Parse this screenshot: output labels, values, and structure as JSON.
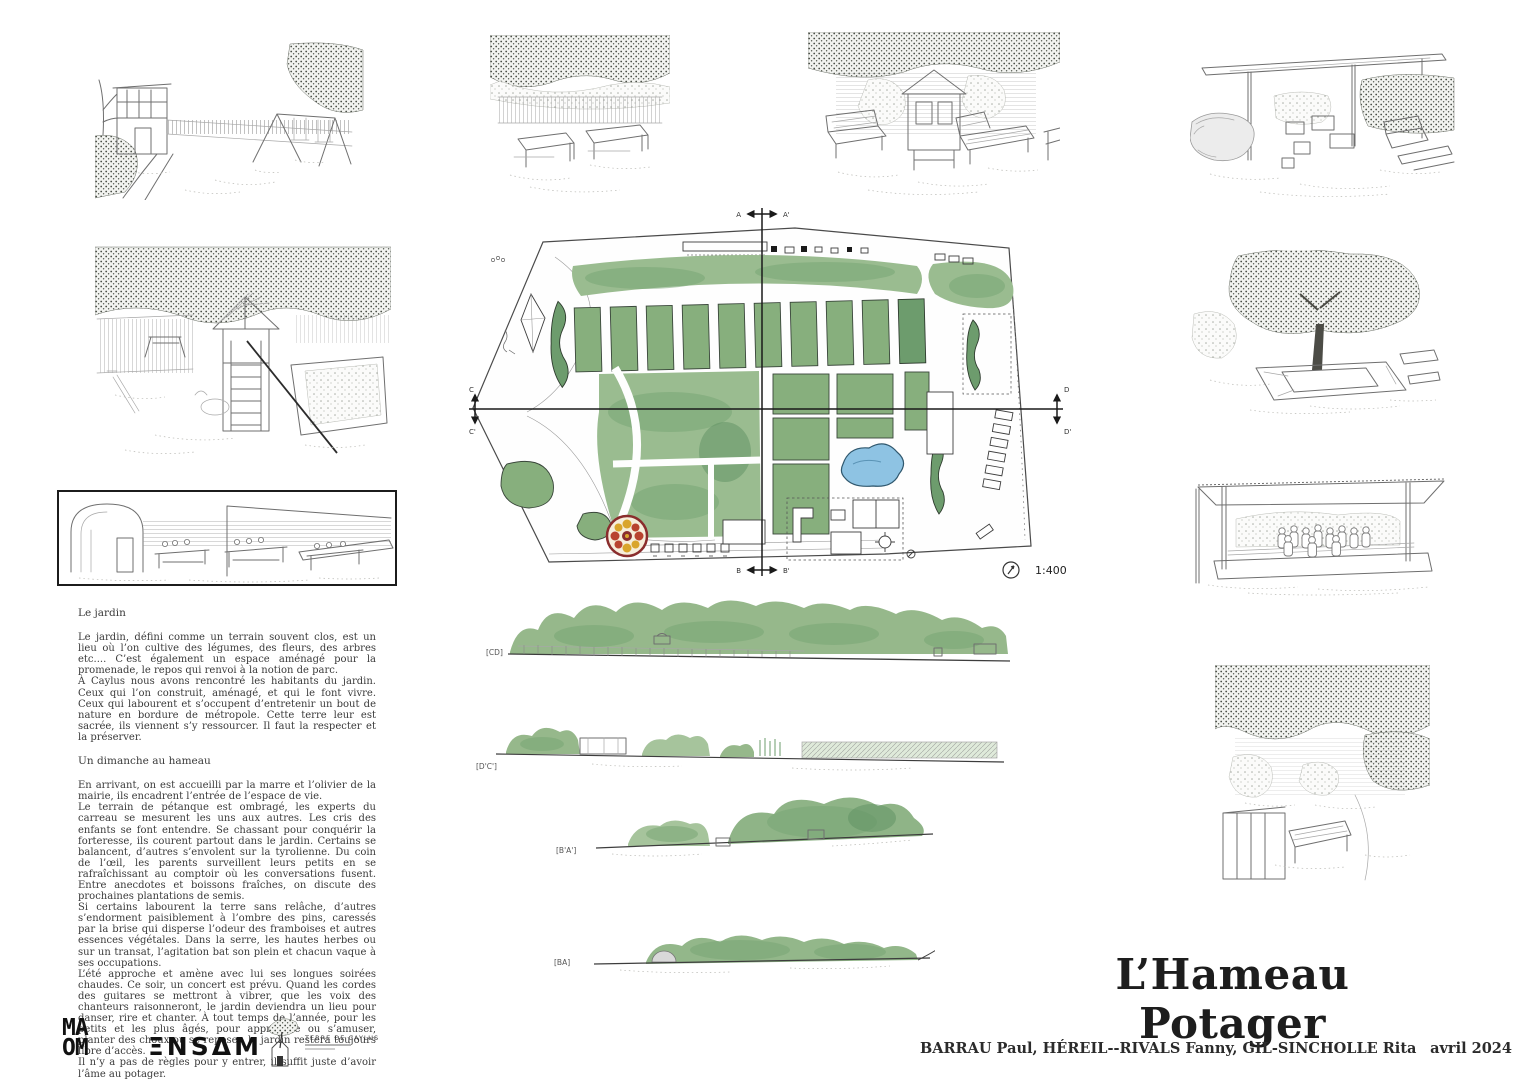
{
  "board": {
    "title": "L’Hameau Potager",
    "credits": "BARRAU Paul, HÉREIL--RIVALS Fanny, GIL-SINCHOLLE Rita",
    "date": "avril 2024"
  },
  "text_panel": {
    "heading_jardin": "Le jardin",
    "jardin_p1": "Le jardin, défini comme un terrain souvent clos, est un lieu où l’on cultive des légumes, des fleurs, des arbres etc.... C’est également un espace aménagé pour la promenade, le repos qui renvoi à la notion de parc.",
    "jardin_p2": "À Caylus nous avons rencontré les habitants du jardin. Ceux qui l’on construit, aménagé, et qui le font vivre. Ceux qui labourent et s’occupent d’entretenir un bout de nature en bordure de métropole. Cette terre leur est sacrée, ils viennent s’y ressourcer. Il faut la respecter et la préserver.",
    "heading_dimanche": "Un dimanche au hameau",
    "dimanche_p1": "En arrivant, on est accueilli par la marre et l’olivier de la mairie, ils encadrent l’entrée de l’espace de vie.",
    "dimanche_p2": "Le terrain de pétanque est ombragé, les experts du carreau se mesurent les uns aux autres. Les cris des enfants se font entendre. Se chassant pour conquérir la forteresse, ils courent partout dans le jardin. Certains se balancent, d’autres s’envolent sur la tyrolienne. Du coin de l’œil, les parents surveillent leurs petits en se rafraîchissant au comptoir où les conversations fusent. Entre anecdotes et boissons fraîches, on discute des prochaines plantations de semis.",
    "dimanche_p3": "Si certains labourent la terre sans relâche, d’autres s’endorment paisiblement à l’ombre des pins, caressés par la brise qui disperse l’odeur des framboises et autres essences végétales. Dans la serre, les hautes herbes ou sur un transat, l’agitation bat son plein et chacun vaque à ses occupations.",
    "dimanche_p4": "L’été approche et amène avec lui ses longues soirées chaudes. Ce soir, un concert est prévu. Quand les cordes des guitares se mettront à vibrer, que les voix des chanteurs raisonneront, le jardin deviendra un lieu pour danser, rire et chanter. À tout temps de l’année, pour les petits et les plus âgés, pour apprendre ou s’amuser, planter des choux ou se reposer, le jardin restera toujours libre d’accès.",
    "dimanche_p5": "Il n’y a pas de règles pour y entrer, il suffit juste d’avoir l’âme au potager."
  },
  "plan": {
    "scale": "1:400",
    "axes": {
      "a": "A",
      "a_prime": "A'",
      "b": "B",
      "b_prime": "B'",
      "c": "C",
      "c_prime": "C'",
      "d": "D",
      "d_prime": "D'"
    }
  },
  "sections": {
    "cd_label": "[CD]",
    "dc_label": "[D'C']",
    "ba_prime_label": "[B'A']",
    "ba_label": "[BA]"
  },
  "logos": {
    "maom_top": "MA",
    "maom_bottom": "OM",
    "ensam": "ΞNSΔM",
    "caylus": "TERRE DE CAYLUS"
  },
  "colors": {
    "foliage_green": "#9abc90",
    "foliage_dark": "#6d9c6d",
    "pond_blue": "#8ec3e3",
    "mandala_red": "#8a2d2d",
    "mandala_yellow": "#d9a52c",
    "ink": "#2f2f2f"
  }
}
